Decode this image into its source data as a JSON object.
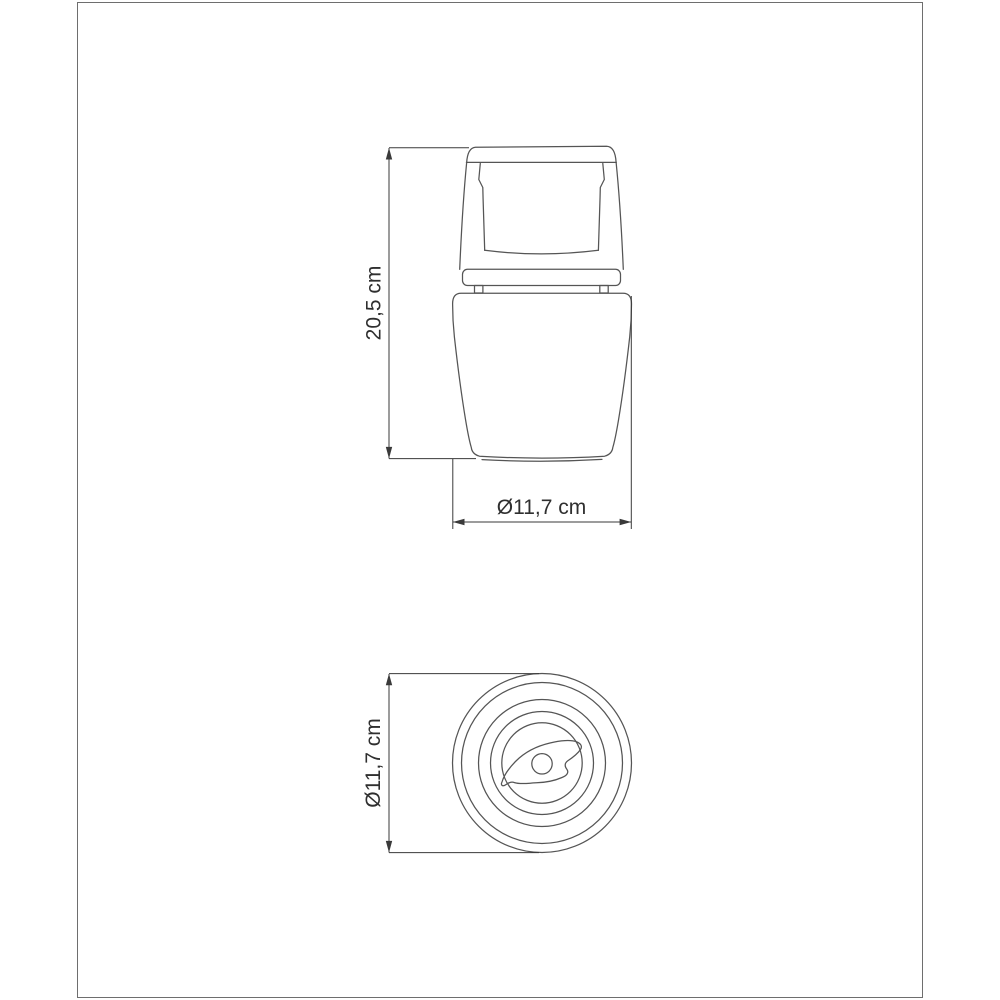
{
  "diagram": {
    "description": "technical dimension drawing, two orthographic views of a coffee grinder",
    "side_view": {
      "height_dimension": {
        "label": "20,5 cm"
      },
      "width_dimension": {
        "label": "Ø11,7 cm"
      }
    },
    "top_view": {
      "diameter_dimension": {
        "label": "Ø11,7 cm"
      }
    }
  },
  "colors": {
    "background": "#ffffff",
    "frame_border": "#6e6e6e",
    "outline_stroke": "#555555",
    "dimension_stroke": "#3a3a3a",
    "label_text": "#2f2f2f"
  }
}
